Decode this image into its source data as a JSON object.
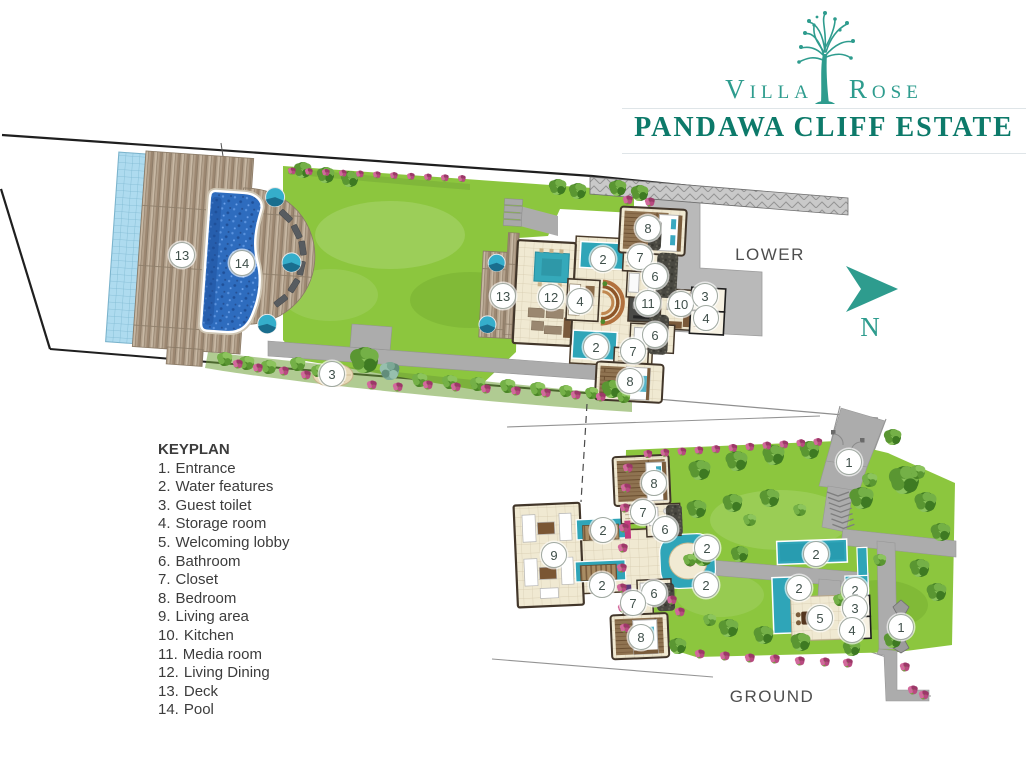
{
  "logo": {
    "brand_first": "Villa",
    "brand_second": "Rose",
    "estate": "PANDAWA CLIFF ESTATE"
  },
  "north_label": "N",
  "plan_labels": {
    "lower": "LOWER",
    "ground": "GROUND"
  },
  "keyplan": {
    "title": "KEYPLAN",
    "items": [
      {
        "num": "1.",
        "label": "Entrance"
      },
      {
        "num": "2.",
        "label": "Water features"
      },
      {
        "num": "3.",
        "label": "Guest toilet"
      },
      {
        "num": "4.",
        "label": "Storage room"
      },
      {
        "num": "5.",
        "label": "Welcoming lobby"
      },
      {
        "num": "6.",
        "label": "Bathroom"
      },
      {
        "num": "7.",
        "label": "Closet"
      },
      {
        "num": "8.",
        "label": "Bedroom"
      },
      {
        "num": "9.",
        "label": "Living area"
      },
      {
        "num": "10.",
        "label": "Kitchen"
      },
      {
        "num": "11.",
        "label": "Media room"
      },
      {
        "num": "12.",
        "label": "Living Dining"
      },
      {
        "num": "13.",
        "label": "Deck"
      },
      {
        "num": "14.",
        "label": "Pool"
      }
    ]
  },
  "markers": {
    "lower": [
      {
        "n": "13",
        "x": 182,
        "y": 255
      },
      {
        "n": "14",
        "x": 242,
        "y": 263
      },
      {
        "n": "3",
        "x": 332,
        "y": 374
      },
      {
        "n": "13",
        "x": 503,
        "y": 296
      },
      {
        "n": "2",
        "x": 603,
        "y": 259
      },
      {
        "n": "12",
        "x": 551,
        "y": 297
      },
      {
        "n": "4",
        "x": 580,
        "y": 301
      },
      {
        "n": "8",
        "x": 648,
        "y": 228
      },
      {
        "n": "7",
        "x": 640,
        "y": 257
      },
      {
        "n": "6",
        "x": 655,
        "y": 276
      },
      {
        "n": "11",
        "x": 648,
        "y": 303
      },
      {
        "n": "10",
        "x": 681,
        "y": 304
      },
      {
        "n": "3",
        "x": 705,
        "y": 296
      },
      {
        "n": "4",
        "x": 706,
        "y": 318
      },
      {
        "n": "6",
        "x": 655,
        "y": 335
      },
      {
        "n": "7",
        "x": 633,
        "y": 351
      },
      {
        "n": "2",
        "x": 596,
        "y": 347
      },
      {
        "n": "8",
        "x": 630,
        "y": 381
      }
    ],
    "ground": [
      {
        "n": "1",
        "x": 849,
        "y": 462
      },
      {
        "n": "8",
        "x": 654,
        "y": 483
      },
      {
        "n": "7",
        "x": 643,
        "y": 512
      },
      {
        "n": "6",
        "x": 665,
        "y": 529
      },
      {
        "n": "2",
        "x": 603,
        "y": 530
      },
      {
        "n": "9",
        "x": 554,
        "y": 555
      },
      {
        "n": "2",
        "x": 707,
        "y": 548
      },
      {
        "n": "2",
        "x": 816,
        "y": 554
      },
      {
        "n": "2",
        "x": 602,
        "y": 585
      },
      {
        "n": "2",
        "x": 706,
        "y": 585
      },
      {
        "n": "2",
        "x": 799,
        "y": 588
      },
      {
        "n": "2",
        "x": 855,
        "y": 590
      },
      {
        "n": "6",
        "x": 654,
        "y": 593
      },
      {
        "n": "7",
        "x": 633,
        "y": 603
      },
      {
        "n": "3",
        "x": 855,
        "y": 608
      },
      {
        "n": "5",
        "x": 820,
        "y": 618
      },
      {
        "n": "1",
        "x": 901,
        "y": 627
      },
      {
        "n": "4",
        "x": 852,
        "y": 630
      },
      {
        "n": "8",
        "x": 641,
        "y": 637
      }
    ]
  },
  "colors": {
    "brand_teal": "#2E9C8E",
    "estate_teal": "#0D7A6A",
    "water_teal": "#2FA5B8",
    "pool_blue": "#2F6FC0",
    "lawn_green": "#8CC63E",
    "path_gray": "#ACACAC",
    "marker_border": "#9FA8A0"
  }
}
